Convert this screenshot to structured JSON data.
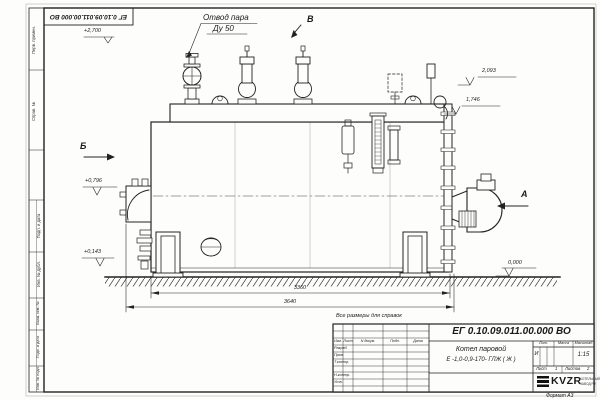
{
  "stamp": {
    "doc_number_inverted": "ЕГ 0.10.09.011.00.000  ВО"
  },
  "annotations": {
    "steam_outlet_line1": "Отвод пара",
    "steam_outlet_line2": "Ду 50",
    "view_a": "А",
    "view_b": "Б",
    "view_v": "В",
    "note": "Все размеры для справок"
  },
  "elevations": {
    "plus2700": "+2,700",
    "r2093": "2,093",
    "r1746": "1,746",
    "plus0796": "+0,796",
    "plus0143": "+0,143",
    "zero": "0,000"
  },
  "dimensions": {
    "length_inner": "3360",
    "length_overall": "3640"
  },
  "title_block": {
    "doc_number": "ЕГ 0.10.09.011.00.000  ВО",
    "name_line1": "Котел паровой",
    "name_line2": "Е -1,0-0,9-170- ГЛЖ ( Ж )",
    "h_izm": "Изм.",
    "h_list": "Лист",
    "h_doc": "N докум.",
    "h_sign": "Подп.",
    "h_date": "Дата",
    "r_razrab": "Разраб.",
    "r_prov": "Пров.",
    "r_tkontr": "Т.контр.",
    "r_nkontr": "Н.контр.",
    "r_utv": "Утв.",
    "h_lit": "Лит.",
    "h_mass": "Масса",
    "h_scale": "Масштаб",
    "lit_value": "И",
    "scale_value": "1:15",
    "sheet_label": "Лист",
    "sheet_value": "1",
    "sheets_label": "Листов",
    "sheets_value": "2",
    "logo_text": "KVZR",
    "logo_sub1": "КОТЕЛЬНЫЙ",
    "logo_sub2": "ЗАВОД РФ"
  },
  "margin": {
    "m1": "Перв. примен.",
    "m2": "Справ. №",
    "m3": "Подп. и дата",
    "m4": "Инв. № дубл.",
    "m5": "Взам. инв. №",
    "m6": "Подп. и дата",
    "m7": "Инв. № подл."
  },
  "footer": {
    "format": "Формат А3"
  }
}
